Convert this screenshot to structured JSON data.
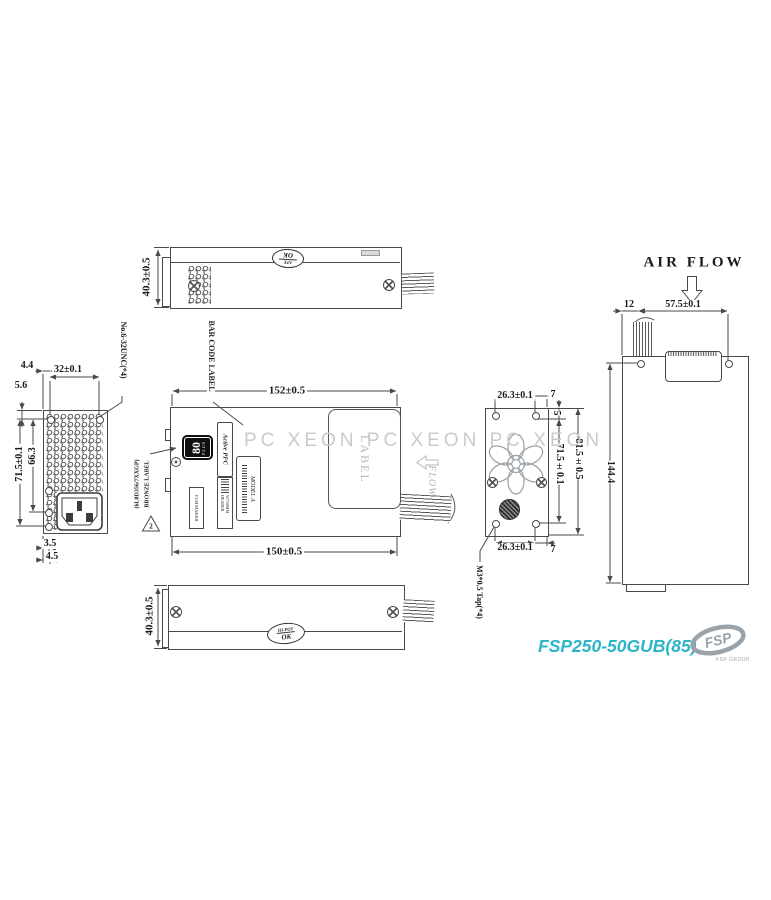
{
  "product": {
    "model": "FSP250-50GUB(85)",
    "logo_text": "FSP",
    "logo_caption": "FSP GROUP"
  },
  "watermark": {
    "text": "PC XEON PC XEON PC XEON"
  },
  "annotations": {
    "air_flow": "AIR FLOW",
    "flow": "FLOW",
    "label_area": "LABEL",
    "bar_code_label": "BAR CODE LABEL",
    "bronze_label_line1": "(6L0D356/7XXGP)",
    "bronze_label_line2": "BRONZE LABEL",
    "bronze_note_number": "2",
    "screw_note": "No.6-32UNC(*4)",
    "tap_note": "M3*0.5 Tap(*4)"
  },
  "stamps": {
    "top": {
      "line1": "ATE",
      "line2": "OK"
    },
    "bottom": {
      "line1": "HI-POT",
      "line2": "OK"
    }
  },
  "labels": {
    "badge_number": "80",
    "badge_sub": "PLUS",
    "active_pfc": "Active PFC",
    "model_label": "MODEL A",
    "header_label": "W/750MM HEADER",
    "maker_label": "FUJI MAKER"
  },
  "dims": {
    "top_view_height": "40.3±0.5",
    "bottom_view_height": "40.3±0.5",
    "main_width_top": "152±0.5",
    "main_width_bottom": "150±0.5",
    "left_d1": "4.4",
    "left_d2": "32±0.1",
    "left_d3": "5.6",
    "left_d4": "66.3",
    "left_d5": "71.5±0.1",
    "left_d6": "3.5",
    "left_d7": "4.5",
    "fan_top": "26.3±0.1",
    "fan_top_off": "7",
    "fan_edge": "5",
    "fan_h1": "71.5±0.1",
    "fan_h2": "81.5±0.5",
    "fan_bottom": "26.3±0.1",
    "fan_bottom_off": "7",
    "rear_d1": "12",
    "rear_d2": "57.5±0.1",
    "rear_d3": "144.4"
  },
  "colors": {
    "accent": "#2ab5c8",
    "line": "#4a4a4a",
    "watermark": "#c7cbcf",
    "annotation_gray": "#b2b8be",
    "logo_gray": "#9aa2aa"
  }
}
